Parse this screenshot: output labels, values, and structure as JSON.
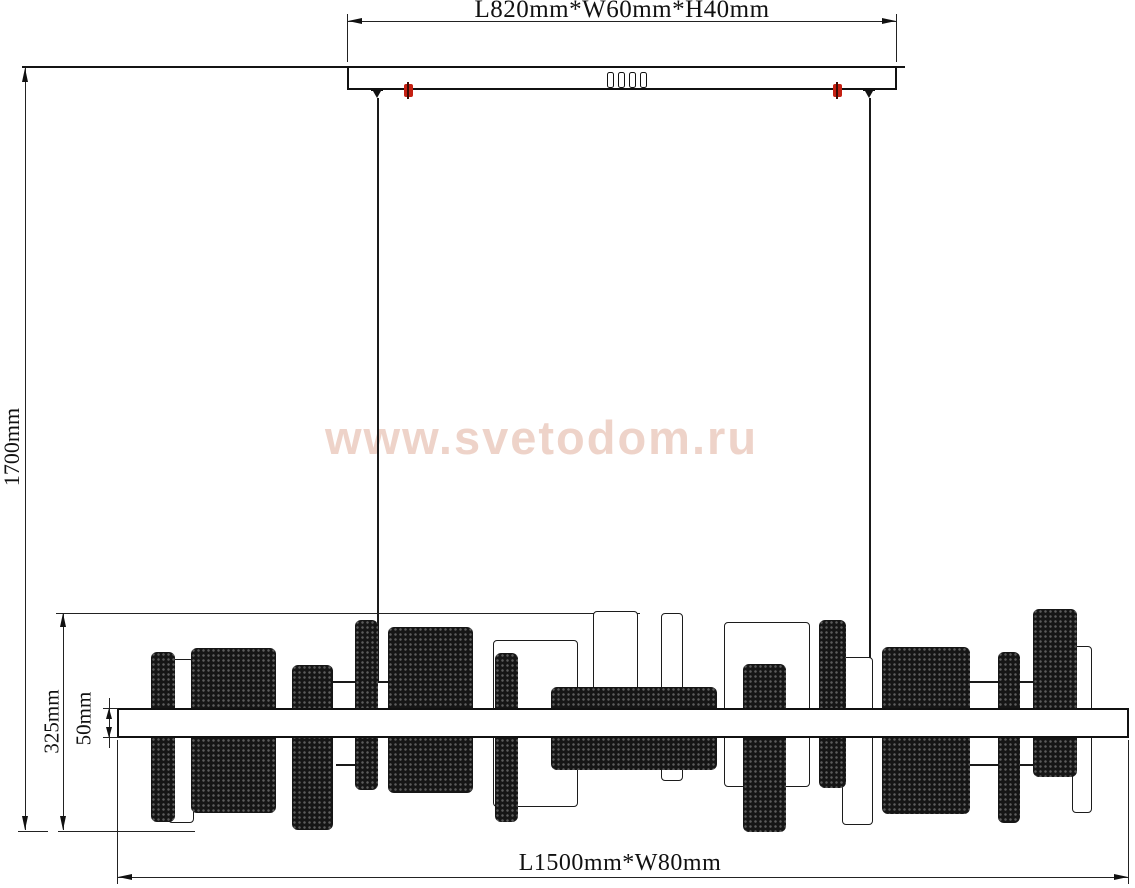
{
  "labels": {
    "canopy_dim": "L820mm*W60mm*H40mm",
    "drop_dim": "1700mm",
    "body_height_dim": "325mm",
    "bar_height_dim": "50mm",
    "body_dim": "L1500mm*W80mm"
  },
  "watermark": {
    "text": "www.svetodom.ru",
    "color": "#eed3c9"
  },
  "colors": {
    "line": "#141414",
    "clip_red": "#c52012",
    "panel_dark": "#161616",
    "panel_light": "#ffffff"
  },
  "drawing": {
    "canopy_slot_count": 4,
    "wires": [
      {
        "x": 377,
        "y1": 98,
        "y2": 681
      },
      {
        "x": 869,
        "y1": 98,
        "y2": 658
      }
    ],
    "rods": [
      {
        "x": 333,
        "y": 681,
        "w": 56
      },
      {
        "x": 970,
        "y": 681,
        "w": 28
      },
      {
        "x": 1020,
        "y": 681,
        "w": 13
      },
      {
        "x": 336,
        "y": 764,
        "w": 22
      },
      {
        "x": 970,
        "y": 764,
        "w": 28
      },
      {
        "x": 1020,
        "y": 764,
        "w": 13
      }
    ],
    "panels": [
      {
        "x": 168,
        "y": 659,
        "w": 26,
        "h": 164,
        "type": "light"
      },
      {
        "x": 493,
        "y": 640,
        "w": 85,
        "h": 167,
        "type": "light"
      },
      {
        "x": 593,
        "y": 611,
        "w": 45,
        "h": 80,
        "type": "light"
      },
      {
        "x": 661,
        "y": 613,
        "w": 22,
        "h": 168,
        "type": "light"
      },
      {
        "x": 724,
        "y": 622,
        "w": 86,
        "h": 165,
        "type": "light"
      },
      {
        "x": 842,
        "y": 657,
        "w": 31,
        "h": 168,
        "type": "light"
      },
      {
        "x": 1072,
        "y": 646,
        "w": 20,
        "h": 167,
        "type": "light"
      },
      {
        "x": 151,
        "y": 652,
        "w": 24,
        "h": 170,
        "type": "dark"
      },
      {
        "x": 191,
        "y": 648,
        "w": 85,
        "h": 165,
        "type": "dark"
      },
      {
        "x": 292,
        "y": 665,
        "w": 41,
        "h": 165,
        "type": "dark"
      },
      {
        "x": 355,
        "y": 620,
        "w": 23,
        "h": 170,
        "type": "dark"
      },
      {
        "x": 388,
        "y": 627,
        "w": 85,
        "h": 166,
        "type": "dark"
      },
      {
        "x": 495,
        "y": 653,
        "w": 23,
        "h": 169,
        "type": "dark"
      },
      {
        "x": 551,
        "y": 687,
        "w": 166,
        "h": 83,
        "type": "dark"
      },
      {
        "x": 743,
        "y": 664,
        "w": 43,
        "h": 168,
        "type": "dark"
      },
      {
        "x": 819,
        "y": 620,
        "w": 27,
        "h": 168,
        "type": "dark"
      },
      {
        "x": 882,
        "y": 647,
        "w": 88,
        "h": 167,
        "type": "dark"
      },
      {
        "x": 998,
        "y": 652,
        "w": 22,
        "h": 171,
        "type": "dark"
      },
      {
        "x": 1033,
        "y": 609,
        "w": 44,
        "h": 168,
        "type": "dark"
      }
    ]
  }
}
